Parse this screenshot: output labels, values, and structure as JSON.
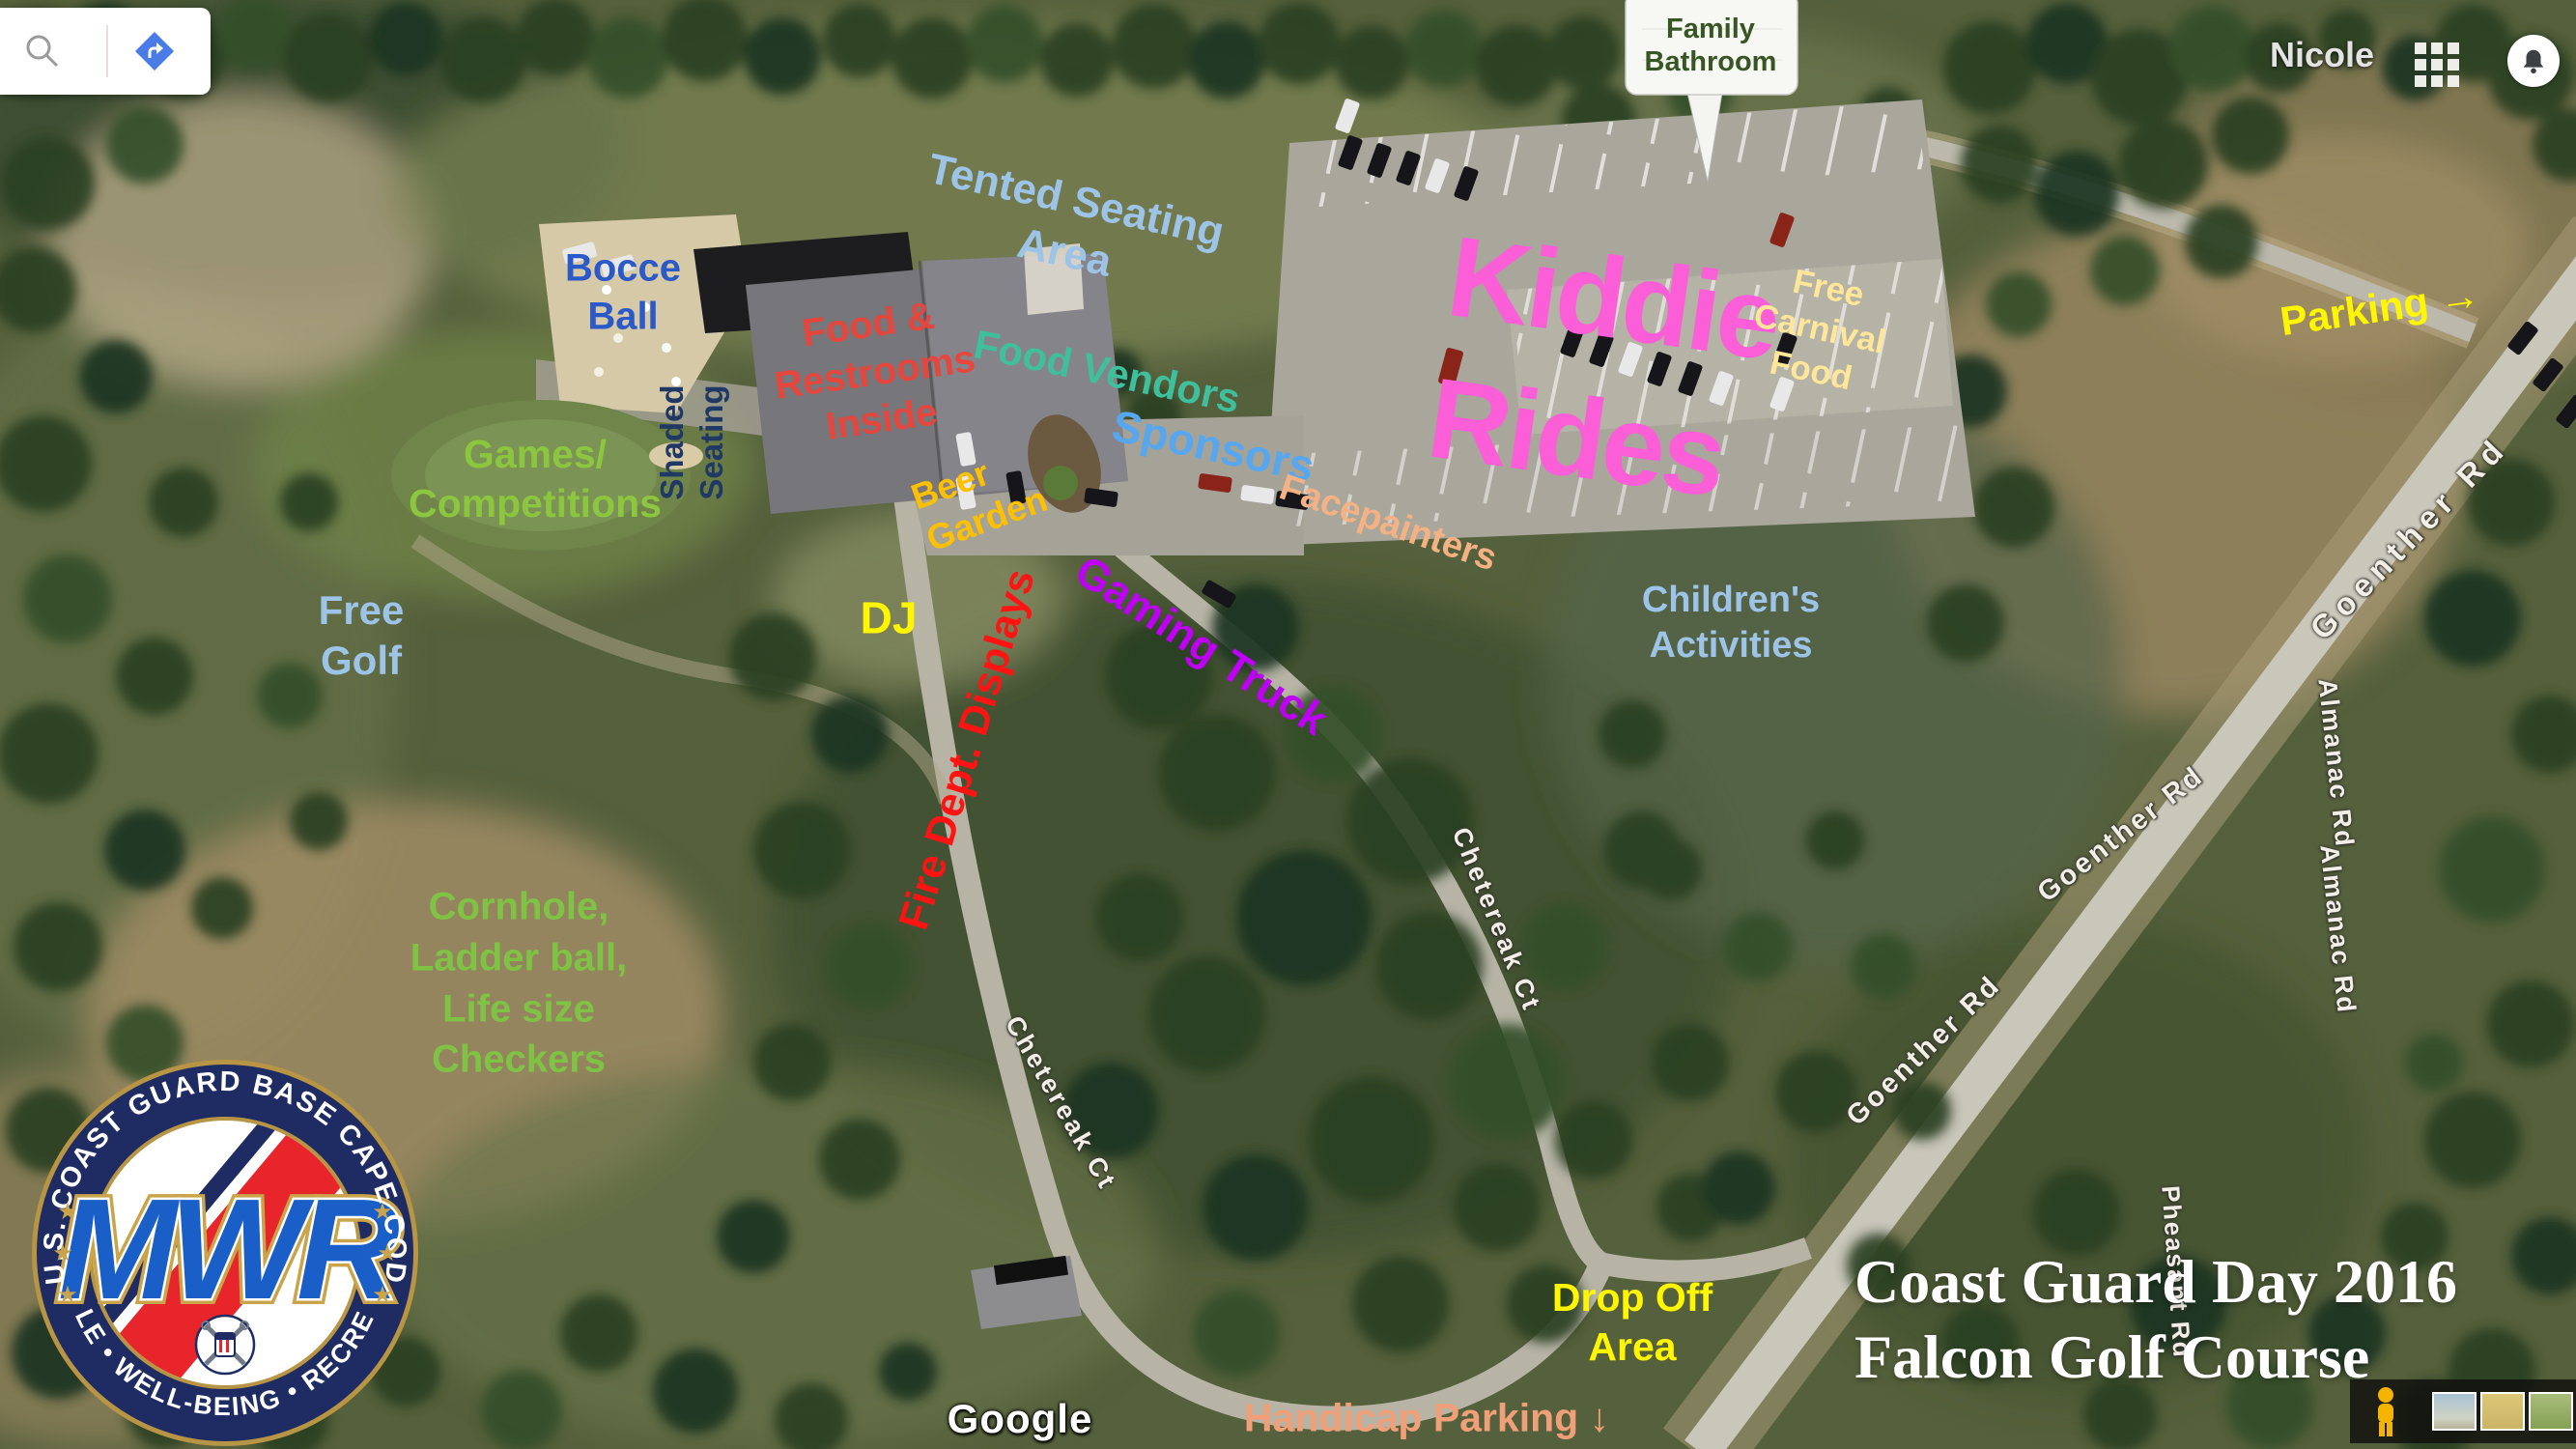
{
  "chrome": {
    "user_name": "Nicole",
    "icons": {
      "search": "magnifier",
      "directions": "blue-diamond-arrow",
      "apps": "3x3-grid",
      "notifications": "bell",
      "pegman": "street-view-person"
    }
  },
  "callout": {
    "family_bathroom": "Family\nBathroom"
  },
  "areas": {
    "tented_seating": "Tented Seating\nArea",
    "bocce": "Bocce\nBall",
    "shaded_seating": "Shaded\nSeating",
    "food_restrooms": "Food &\nRestrooms\nInside",
    "food_vendors": "Food Vendors",
    "beer_garden": "Beer\nGarden",
    "sponsors": "Sponsors",
    "facepainters": "Facepainters",
    "kiddie_rides": "Kiddie\nRides",
    "free_carnival_food": "Free\nCarnival\nFood",
    "parking": "Parking →",
    "childrens_activities": "Children's\nActivities",
    "free_golf": "Free\nGolf",
    "games_competitions": "Games/\nCompetitions",
    "dj": "DJ",
    "fire_dept_displays": "Fire Dept. Displays",
    "gaming_truck": "Gaming Truck",
    "cornhole": "Cornhole,\nLadder ball,\nLife size\nCheckers",
    "drop_off": "Drop Off\nArea",
    "handicap_parking": "Handicap Parking ↓"
  },
  "roads": {
    "goenther_1": "Goenther Rd",
    "goenther_2": "Goenther Rd",
    "goenther_3": "Goenther Rd",
    "almanac_1": "Almanac Rd",
    "almanac_2": "Almanac Rd",
    "pheasant": "Pheasant Rd",
    "chetereak_1": "Chetereak Ct",
    "chetereak_2": "Chetereak Ct"
  },
  "watermark": {
    "google": "Google"
  },
  "title": {
    "text": "Coast Guard Day 2016\nFalcon Golf Course"
  },
  "logo": {
    "ring_top": "U.S. COAST GUARD BASE  CAPE COD",
    "ring_bottom": "MORALE • WELL-BEING • RECREATION",
    "monogram": "MWR",
    "star": "★"
  },
  "colors": {
    "light_blue_label": "#9DC3E6",
    "blue_label": "#2B59C8",
    "navy_label": "#1F3864",
    "red_label": "#E5463D",
    "bright_red_label": "#FF1313",
    "teal_label": "#3FBF9C",
    "gold_label": "#FFC000",
    "sky_label": "#57A7F0",
    "peach_label": "#F4B183",
    "pink_label": "#FB5ED6",
    "pale_yellow_label": "#FFE699",
    "yellow_label": "#FFF600",
    "green_label": "#8CC63E",
    "purple_label": "#BE01F5",
    "salmon_label": "#F0A078",
    "callout_green": "#375623"
  }
}
